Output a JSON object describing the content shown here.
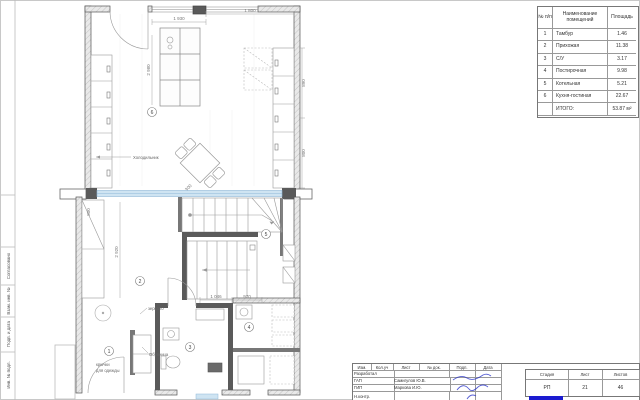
{
  "room_table": {
    "header": {
      "num": "№ п/п",
      "name": "Наименование помещений",
      "area": "Площадь"
    },
    "rows": [
      {
        "num": "1",
        "name": "Тамбур",
        "area": "1.46"
      },
      {
        "num": "2",
        "name": "Прихожая",
        "area": "11.38"
      },
      {
        "num": "3",
        "name": "С/У",
        "area": "3.17"
      },
      {
        "num": "4",
        "name": "Постирочная",
        "area": "9.98"
      },
      {
        "num": "5",
        "name": "Котельная",
        "area": "5.21"
      },
      {
        "num": "6",
        "name": "Кухня-гостиная",
        "area": "22.67"
      }
    ],
    "total_label": "ИТОГО:",
    "total_value": "53.87 м²"
  },
  "title_block": {
    "header_cols": [
      "Изм.",
      "Кол.уч",
      "Лист",
      "№ док.",
      "Подп.",
      "Дата"
    ],
    "rows": [
      {
        "role": "Разработал",
        "name": ""
      },
      {
        "role": "ГАП",
        "name": "Самигулов Ю.В."
      },
      {
        "role": "ГИП",
        "name": "Маркова И.Ю."
      },
      {
        "role": "Н.контр.",
        "name": ""
      }
    ],
    "stage": {
      "label": "Стадия",
      "value": "РП"
    },
    "sheet": {
      "label": "Лист",
      "value": "21"
    },
    "sheets": {
      "label": "Листов",
      "value": "46"
    }
  },
  "frame": {
    "side_labels": [
      "Согласовано",
      "Взам. инв. №",
      "Подп. и дата",
      "Инв. № подл."
    ]
  },
  "plan": {
    "badges": [
      "1",
      "2",
      "3",
      "4",
      "5",
      "6"
    ],
    "labels": {
      "fridge": "Холодильник",
      "shoe_cabinet": "Обувница",
      "hooks_line1": "крючки",
      "hooks_line2": "для одежды",
      "mirror": "зеркало"
    },
    "dims": {
      "top_left": "1 930",
      "top_right": "1 800",
      "upper_left": "2 980",
      "right_a": "890",
      "right_b": "800",
      "island": "1 300",
      "closet": "800",
      "corridor": "2 920",
      "bottom_a": "1 046",
      "bottom_b": "970"
    }
  },
  "colors": {
    "glass_blue": "#cfe4f2",
    "stamp_blue": "#2a35c8",
    "logo_blue": "#1b1bd0",
    "wall_gray": "#555555"
  }
}
